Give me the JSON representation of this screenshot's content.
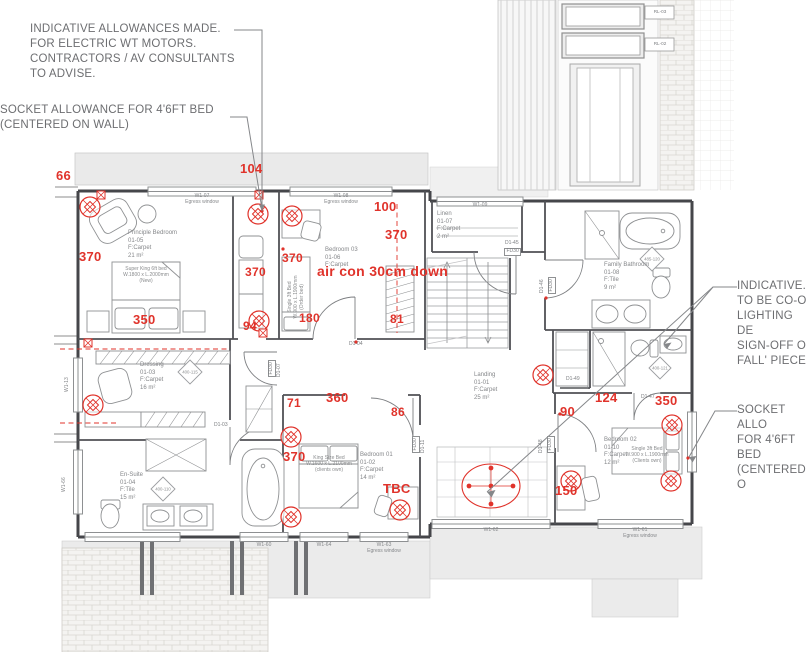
{
  "colors": {
    "red": "#e0332b",
    "wall": "#45464a",
    "annotation_gray": "#6d6e71",
    "label_gray": "#85878a",
    "fill_gray": "#ebebeb"
  },
  "annotations": {
    "top_left": {
      "text": "INDICATIVE ALLOWANCES MADE.\nFOR ELECTRIC WT MOTORS.\nCONTRACTORS / AV CONSULTANTS\nTO ADVISE."
    },
    "mid_left": {
      "text": "SOCKET ALLOWANCE FOR 4'6FT BED\n(CENTERED ON WALL)"
    },
    "right_upper": {
      "text": "INDICATIVE.\nTO BE CO-O\nLIGHTING DE\nSIGN-OFF O\nFALL' PIECE"
    },
    "right_lower": {
      "text": "SOCKET ALLO\nFOR 4'6FT BED\n(CENTERED O"
    }
  },
  "rooms": [
    {
      "lines": [
        "Principle Bedroom",
        "01-05",
        "F:Carpet",
        "21  m²"
      ],
      "x": 128,
      "y": 230
    },
    {
      "lines": [
        "Bedroom  03",
        "01-06",
        "F:Carpet"
      ],
      "x": 325,
      "y": 247
    },
    {
      "lines": [
        "Linen",
        "01-07",
        "F:Carpet",
        "2   m²"
      ],
      "x": 437,
      "y": 211
    },
    {
      "lines": [
        "Family Bathroom",
        "01-08",
        "F:Tile",
        "9   m²"
      ],
      "x": 604,
      "y": 262
    },
    {
      "lines": [
        "Dressing",
        "01-03",
        "F:Carpet",
        "16   m²"
      ],
      "x": 140,
      "y": 362
    },
    {
      "lines": [
        "Landing",
        "01-01",
        "F:Carpet",
        "25   m²"
      ],
      "x": 474,
      "y": 372
    },
    {
      "lines": [
        "En-Suite",
        "01-04",
        "F:Tile",
        "15   m²"
      ],
      "x": 120,
      "y": 472
    },
    {
      "lines": [
        "Bedroom  01",
        "01-02",
        "F:Carpet",
        "14   m²"
      ],
      "x": 360,
      "y": 452
    },
    {
      "lines": [
        "Bedroom  02",
        "01-10",
        "F:Carpet",
        "12   m²"
      ],
      "x": 604,
      "y": 437
    }
  ],
  "beds": [
    {
      "lines": [
        "Super King 6ft bed",
        "W.1800 x L.2000mm",
        "(New)"
      ],
      "x": 112,
      "y": 266,
      "w": 68,
      "rot": 0
    },
    {
      "lines": [
        "King Size Bed",
        "W.1600 x L.2100mm",
        "(clients own)"
      ],
      "x": 300,
      "y": 455,
      "w": 58,
      "rot": 0
    },
    {
      "lines": [
        "Single 3ft Bed",
        "W.900 x L.1900mm",
        "(Clients own)"
      ],
      "x": 614,
      "y": 446,
      "w": 66,
      "rot": 0
    },
    {
      "lines": [
        "Single 3ft Bed",
        "W.900 x L.1900mm",
        "(Order bed)"
      ],
      "x": 287,
      "y": 333,
      "w": 72,
      "rot": -90
    }
  ],
  "dims": [
    {
      "t": "66",
      "x": 56,
      "y": 168,
      "fs": 13
    },
    {
      "t": "104",
      "x": 240,
      "y": 161,
      "fs": 13
    },
    {
      "t": "100",
      "x": 374,
      "y": 199,
      "fs": 13
    },
    {
      "t": "370",
      "x": 79,
      "y": 249,
      "fs": 13
    },
    {
      "t": "370",
      "x": 385,
      "y": 227,
      "fs": 13
    },
    {
      "t": "370",
      "x": 282,
      "y": 251,
      "fs": 12
    },
    {
      "t": "370",
      "x": 245,
      "y": 265,
      "fs": 12
    },
    {
      "t": "air con 30cm down",
      "x": 317,
      "y": 263,
      "fs": 14
    },
    {
      "t": "350",
      "x": 133,
      "y": 312,
      "fs": 13
    },
    {
      "t": "94",
      "x": 243,
      "y": 319,
      "fs": 12
    },
    {
      "t": "180",
      "x": 299,
      "y": 311,
      "fs": 12
    },
    {
      "t": "81",
      "x": 390,
      "y": 312,
      "fs": 12
    },
    {
      "t": "71",
      "x": 287,
      "y": 396,
      "fs": 12
    },
    {
      "t": "360",
      "x": 326,
      "y": 390,
      "fs": 13
    },
    {
      "t": "86",
      "x": 391,
      "y": 405,
      "fs": 12
    },
    {
      "t": "370",
      "x": 283,
      "y": 449,
      "fs": 13
    },
    {
      "t": "TBC",
      "x": 383,
      "y": 481,
      "fs": 13
    },
    {
      "t": "90",
      "x": 560,
      "y": 404,
      "fs": 13
    },
    {
      "t": "124",
      "x": 595,
      "y": 390,
      "fs": 13
    },
    {
      "t": "350",
      "x": 655,
      "y": 393,
      "fs": 13
    },
    {
      "t": "150",
      "x": 555,
      "y": 483,
      "fs": 13
    }
  ],
  "wall_tags": [
    {
      "t": "W1-07",
      "sub": "Egress window",
      "x": 202,
      "y": 193
    },
    {
      "t": "W1-08",
      "sub": "Egress window",
      "x": 341,
      "y": 193
    },
    {
      "t": "W1-09",
      "x": 480,
      "y": 202
    },
    {
      "t": "W1-60",
      "x": 264,
      "y": 542
    },
    {
      "t": "W1-64",
      "x": 324,
      "y": 542
    },
    {
      "t": "W1-63",
      "sub": "Egress window",
      "x": 384,
      "y": 542
    },
    {
      "t": "W1-62",
      "x": 491,
      "y": 527
    },
    {
      "t": "W1-61",
      "sub": "Egress window",
      "x": 640,
      "y": 527
    },
    {
      "t": "W1-13",
      "x": 64,
      "y": 392,
      "rot": -90
    },
    {
      "t": "W1-66",
      "x": 61,
      "y": 492,
      "rot": -90
    }
  ],
  "door_tags": [
    {
      "t": "D1-04",
      "x": 349,
      "y": 342
    },
    {
      "t": "D1-03",
      "x": 214,
      "y": 423
    },
    {
      "t": "FD30",
      "x": 268,
      "y": 377,
      "rot": -90,
      "boxed": true
    },
    {
      "t": "D1-07",
      "x": 277,
      "y": 377,
      "rot": -90
    },
    {
      "t": "D1-45",
      "x": 505,
      "y": 241
    },
    {
      "t": "FD30",
      "x": 504,
      "y": 248,
      "boxed": true
    },
    {
      "t": "D1-46",
      "x": 540,
      "y": 293,
      "rot": -90
    },
    {
      "t": "FD30",
      "x": 548,
      "y": 294,
      "rot": -90,
      "boxed": true
    },
    {
      "t": "D1-49",
      "x": 566,
      "y": 377
    },
    {
      "t": "D1-47",
      "x": 641,
      "y": 395
    },
    {
      "t": "D1-48",
      "x": 539,
      "y": 453,
      "rot": -90
    },
    {
      "t": "FD30",
      "x": 547,
      "y": 453,
      "rot": -90,
      "boxed": true
    },
    {
      "t": "D1-11",
      "x": 421,
      "y": 453,
      "rot": -90
    },
    {
      "t": "FD30",
      "x": 412,
      "y": 453,
      "rot": -90,
      "boxed": true
    }
  ],
  "fixture_tags": [
    {
      "t": "400-115",
      "x": 190,
      "y": 372
    },
    {
      "t": "400-110",
      "x": 163,
      "y": 489
    },
    {
      "t": "485-120",
      "x": 652,
      "y": 259
    },
    {
      "t": "400-121",
      "x": 660,
      "y": 368
    }
  ],
  "roof_tags": [
    {
      "t": "RL-03",
      "x": 646,
      "y": 6
    },
    {
      "t": "RL-02",
      "x": 646,
      "y": 38
    }
  ]
}
